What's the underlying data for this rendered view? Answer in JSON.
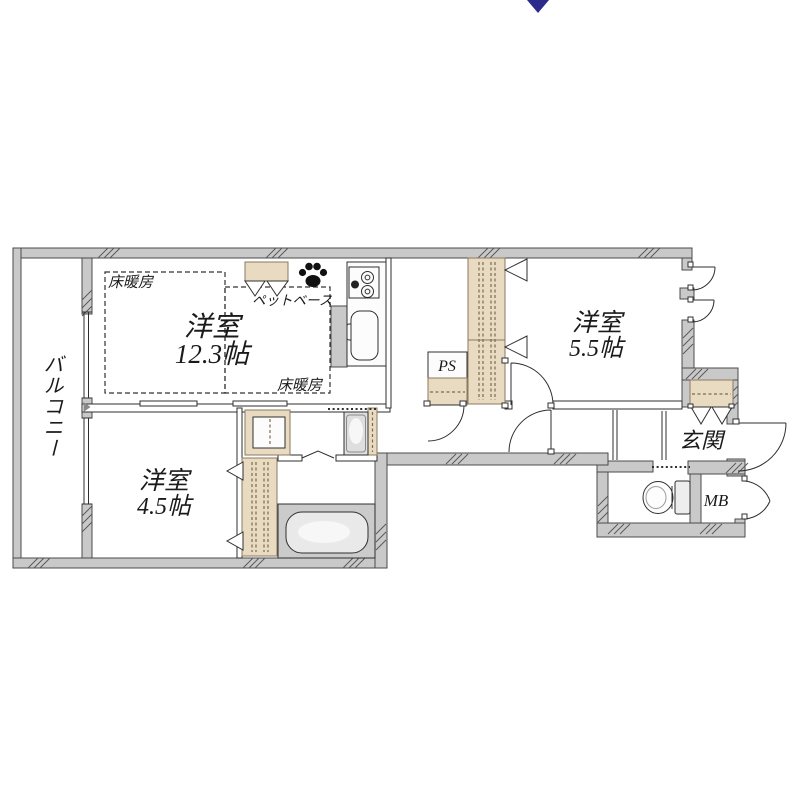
{
  "labels": {
    "balcony": "バルコニー",
    "entrance": "玄関",
    "pipe_space": "PS",
    "meter_box": "MB",
    "floor_heating": "床暖房",
    "pet_base": "ペットベース"
  },
  "rooms": [
    {
      "name": "洋室",
      "size": "12.3帖"
    },
    {
      "name": "洋室",
      "size": "4.5帖"
    },
    {
      "name": "洋室",
      "size": "5.5帖"
    }
  ],
  "icons": {
    "paw": "paw-print",
    "compass": "north-arrow"
  },
  "colors": {
    "wall_fill": "#c9c9c9",
    "wall_stroke": "#4b4b4b",
    "line": "#2f2f2f",
    "closet_fill": "#e8dbc2",
    "closet_stroke": "#8a7a5e",
    "closet_dash": "#7b6a4f",
    "bath_floor": "#cbcbcb",
    "tub_fill": "#e9e9e9",
    "arrow_color": "#2b2b8c",
    "text_color": "#1a1a1a"
  }
}
